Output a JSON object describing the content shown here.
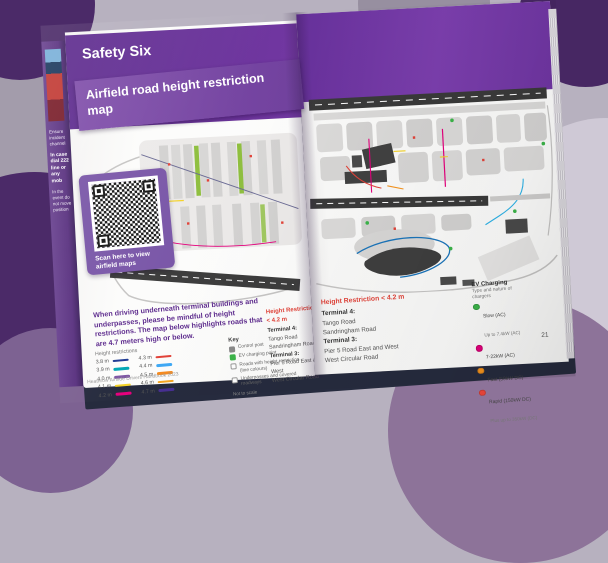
{
  "palette": {
    "accent_purple": "#5e2c8e",
    "ribbon_purple": "#7e4aa8",
    "heading_red": "#e24339",
    "background_dark_purple": "#4b2a68",
    "background_mauve": "#8d7399"
  },
  "prev_page": {
    "fragments": [
      "Ensure incident channel",
      "In case dial 222 line or any mob",
      "In the event do not move position"
    ]
  },
  "left_page": {
    "header_title": "Safety Six",
    "ribbon_title": "Airfield road height restriction map",
    "qr_caption": "Scan here to view airfield maps",
    "paragraph": "When driving underneath terminal buildings and underpasses, please be mindful of height restrictions. The map below highlights roads that are 4.7 meters high or below.",
    "legend": {
      "title": "Height restrictions",
      "entries": [
        {
          "label": "3.8 m",
          "color": "#1f3a93"
        },
        {
          "label": "3.9 m",
          "color": "#00a7b5"
        },
        {
          "label": "4.0 m",
          "color": "#7e57a5"
        },
        {
          "label": "4.1 m",
          "color": "#f5d327"
        },
        {
          "label": "4.2 m",
          "color": "#e5007d"
        },
        {
          "label": "4.3 m",
          "color": "#e24339"
        },
        {
          "label": "4.4 m",
          "color": "#3fa9f5"
        },
        {
          "label": "4.5 m",
          "color": "#f68b1f"
        },
        {
          "label": "4.6 m",
          "color": "#f5a623"
        },
        {
          "label": "4.7 m",
          "color": "#472f92"
        }
      ]
    },
    "key": {
      "title": "Key",
      "items": [
        {
          "label": "Control post",
          "color": "#8a8a8a",
          "style": "filled"
        },
        {
          "label": "EV charging point",
          "color": "#3cb54a",
          "style": "filled"
        },
        {
          "label": "Roads with height restriction (line colours)",
          "color": "#ffffff",
          "style": "outline"
        },
        {
          "label": "Underpasses and covered roadways",
          "color": "#ffffff",
          "style": "outline"
        }
      ],
      "note": "Not to scale"
    },
    "footer": "Heathrow Airside Drivers Handbook 2023"
  },
  "restriction_list": {
    "heading": "Height Restriction < 4.2 m",
    "sections": [
      {
        "title": "Terminal 4:",
        "roads": [
          "Tango Road",
          "Sandringham Road"
        ]
      },
      {
        "title": "Terminal 3:",
        "roads": [
          "Pier 5 Road East and West",
          "West Circular Road"
        ]
      }
    ]
  },
  "right_page": {
    "ev_charging": {
      "title": "EV Charging",
      "subtitle": "Type and nature of chargers",
      "entries": [
        {
          "label": "Slow (AC)",
          "sub": "Up to 7.4kW (AC)",
          "color": "#3cb54a"
        },
        {
          "label": "7-22kW (AC)",
          "sub": "",
          "color": "#e5007d"
        },
        {
          "label": "Fast (50kW DC)",
          "sub": "",
          "color": "#f7941d"
        },
        {
          "label": "Rapid (150kW DC)",
          "sub": "Plus up to 350kW (DC)",
          "color": "#e24339"
        }
      ]
    },
    "page_number": "21"
  }
}
